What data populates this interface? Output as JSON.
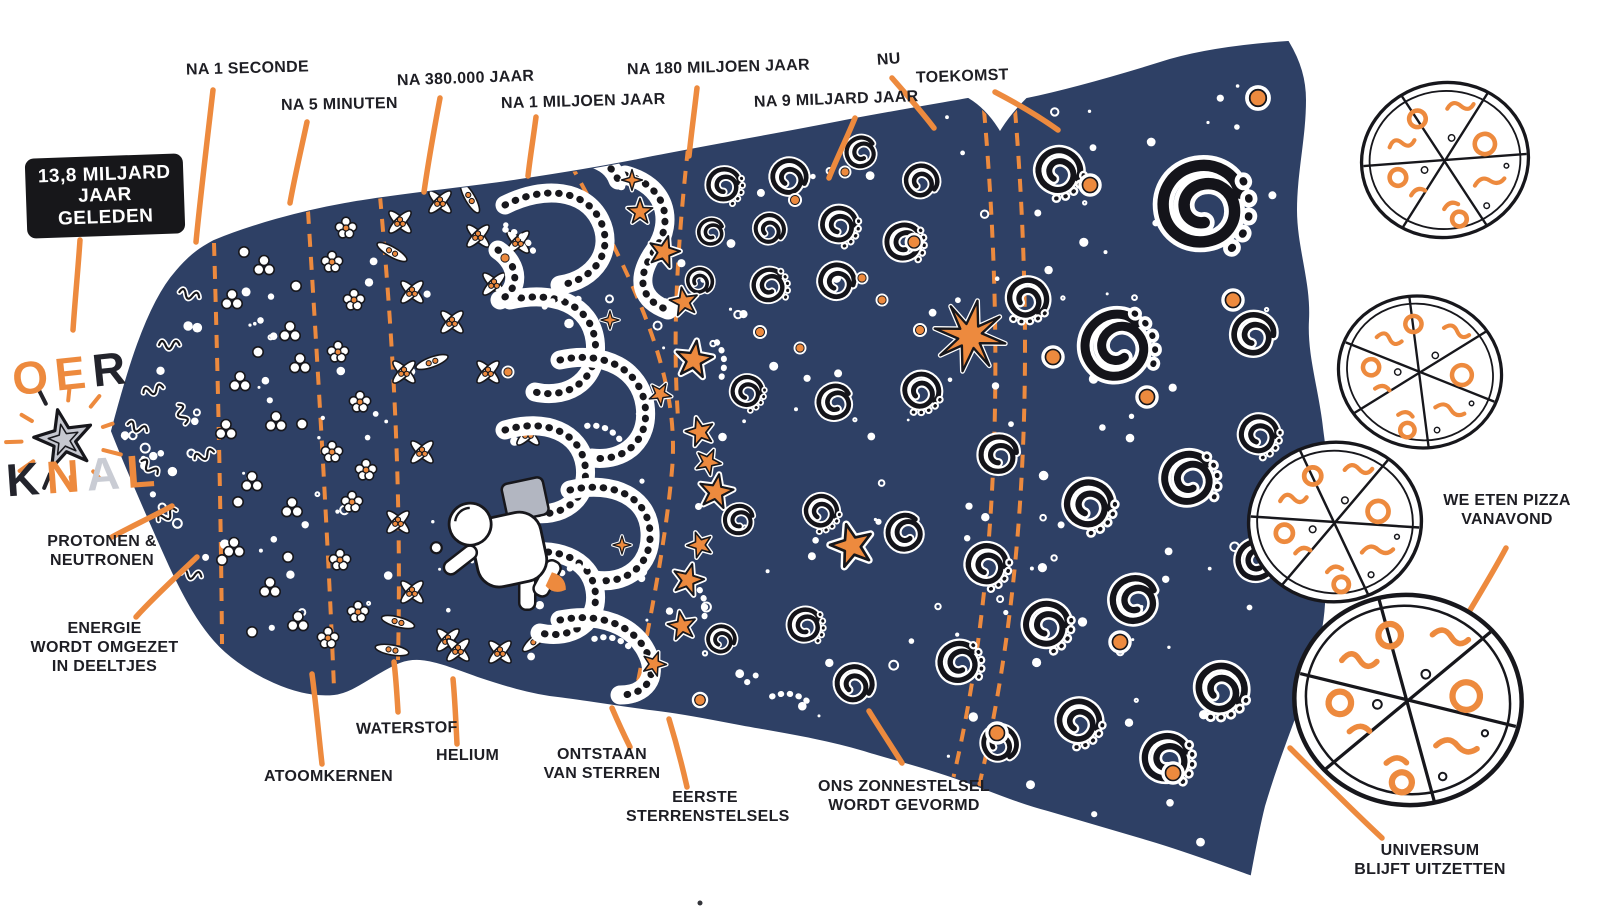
{
  "poster": {
    "language": "nl",
    "subject": "Oerknal / Big Bang timeline illustration"
  },
  "colors": {
    "navy": "#2E4065",
    "orange": "#ED8A3E",
    "ink": "#17171C",
    "paper": "#FFFFFF"
  },
  "labels": {
    "after_1_second": "NA 1 SECONDE",
    "after_5_minutes": "NA 5 MINUTEN",
    "after_380000_years": "NA 380.000 JAAR",
    "after_1_million_years": "NA 1 MILJOEN JAAR",
    "after_180_million_years": "NA 180 MILJOEN JAAR",
    "after_9_billion_years": "NA 9 MILJARD JAAR",
    "now": "NU",
    "future": "TOEKOMST",
    "origin_time": "13,8 MILJARD\nJAAR GELEDEN",
    "big_bang_top": "OER",
    "big_bang_bottom": "KNAL",
    "protons_neutrons": "PROTONEN &\nNEUTRONEN",
    "energy_to_particles": "ENERGIE\nWORDT OMGEZET\nIN DEELTJES",
    "atomic_nuclei": "ATOOMKERNEN",
    "hydrogen": "WATERSTOF",
    "helium": "HELIUM",
    "star_formation": "ONTSTAAN\nVAN STERREN",
    "first_galaxies": "EERSTE\nSTERRENSTELSELS",
    "solar_system": "ONS ZONNESTELSEL\nWORDT GEVORMD",
    "universe_expands": "UNIVERSUM\nBLIJFT UITZETTEN",
    "pizza_tonight": "WE ETEN PIZZA\nVANAVOND"
  }
}
